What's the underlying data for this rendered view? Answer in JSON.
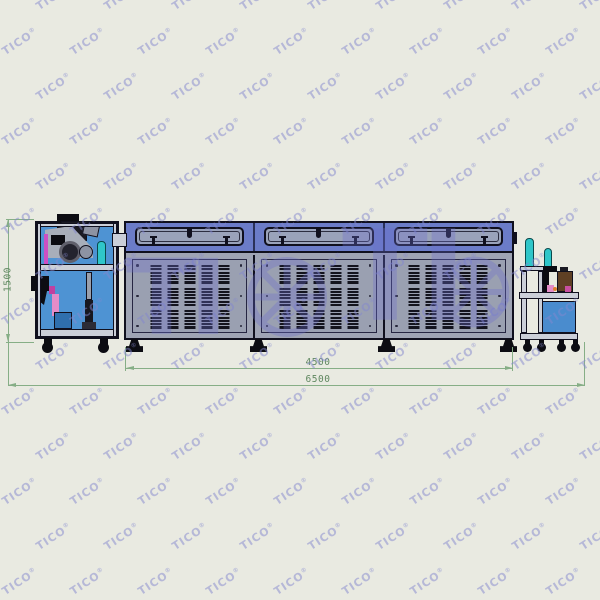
{
  "watermark": {
    "text": "TICO",
    "registered": "®",
    "big_text": "TI"
  },
  "drawing": {
    "dimensions": {
      "height": {
        "value": "1500"
      },
      "tunnel_length": {
        "value": "4500"
      },
      "total_length": {
        "value": "6500"
      }
    },
    "machine": {
      "tunnel_sections": 3,
      "vent_columns": 5,
      "vent_groups": 3,
      "vent_slats": 6
    }
  },
  "colors": {
    "bg": "#e9eae1",
    "line": "#10101e",
    "band": "#6b7cc8",
    "bdiv": "#2a3158",
    "win": "#9aa3ba",
    "bodyc": "#9fa4b4",
    "panel": "#9aa0b1",
    "slat": "#14141e",
    "feeder": "#4e93d3",
    "frame": "#cbcfd8",
    "teal": "#2fc6c9",
    "teald": "#0a4a4c",
    "mag": "#cc4fc4",
    "pink": "#e48cc8",
    "brown": "#5f4024",
    "cab": "#4a8cce",
    "black": "#0c0c12",
    "steel": "#9aa0ac",
    "steeld": "#2c2c36",
    "dim": "#86ae86",
    "dimtext": "#5f875f",
    "wm": "#8488cf",
    "wmbig": "#6c6ecd"
  }
}
